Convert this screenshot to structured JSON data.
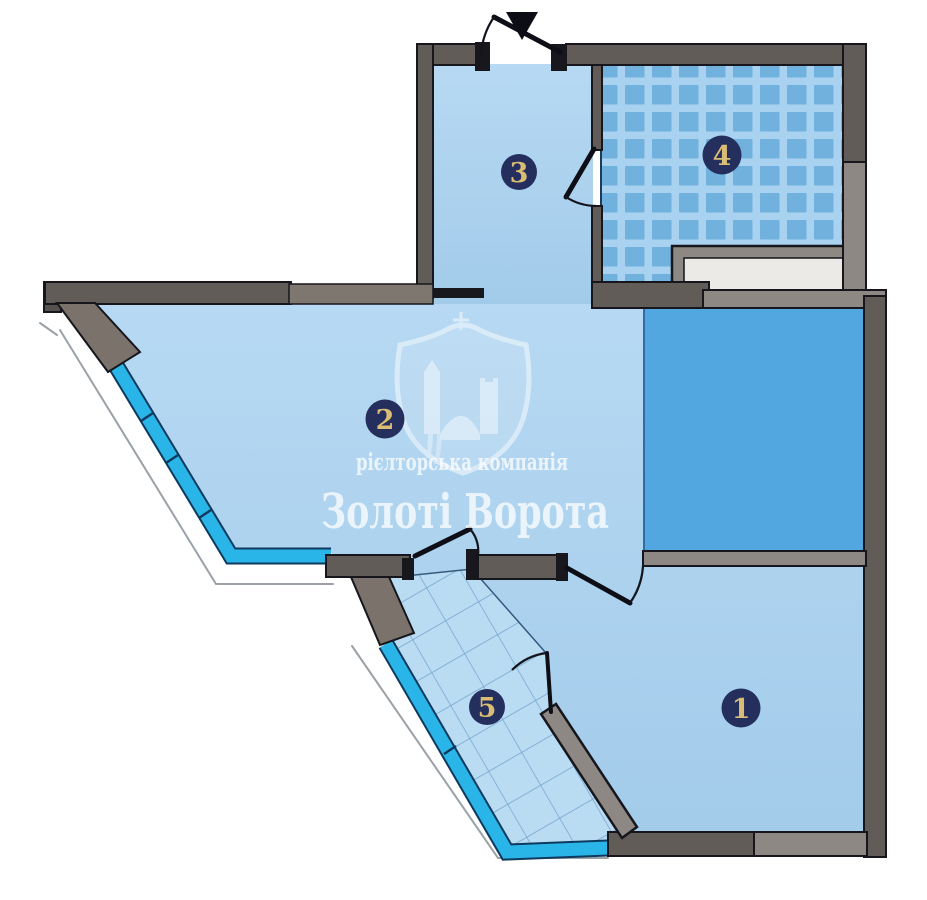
{
  "floorplan": {
    "rooms": [
      {
        "number": "1"
      },
      {
        "number": "2"
      },
      {
        "number": "3"
      },
      {
        "number": "4"
      },
      {
        "number": "5"
      }
    ],
    "watermark": {
      "company_type": "рієлторська компанія",
      "company_name": "Золоті Ворота"
    },
    "colors": {
      "room_fill": "#ADD2EF",
      "tile_blue": "#70B1DE",
      "tile_grout": "#A8D2EF",
      "loggia_blue": "#52A7E0",
      "window_cyan": "#2AB5E8",
      "wall_dark_gray": "#615C57",
      "wall_light_gray": "#8D8883",
      "badge_navy": "#252F5D",
      "badge_gold": "#D9BD75"
    }
  }
}
